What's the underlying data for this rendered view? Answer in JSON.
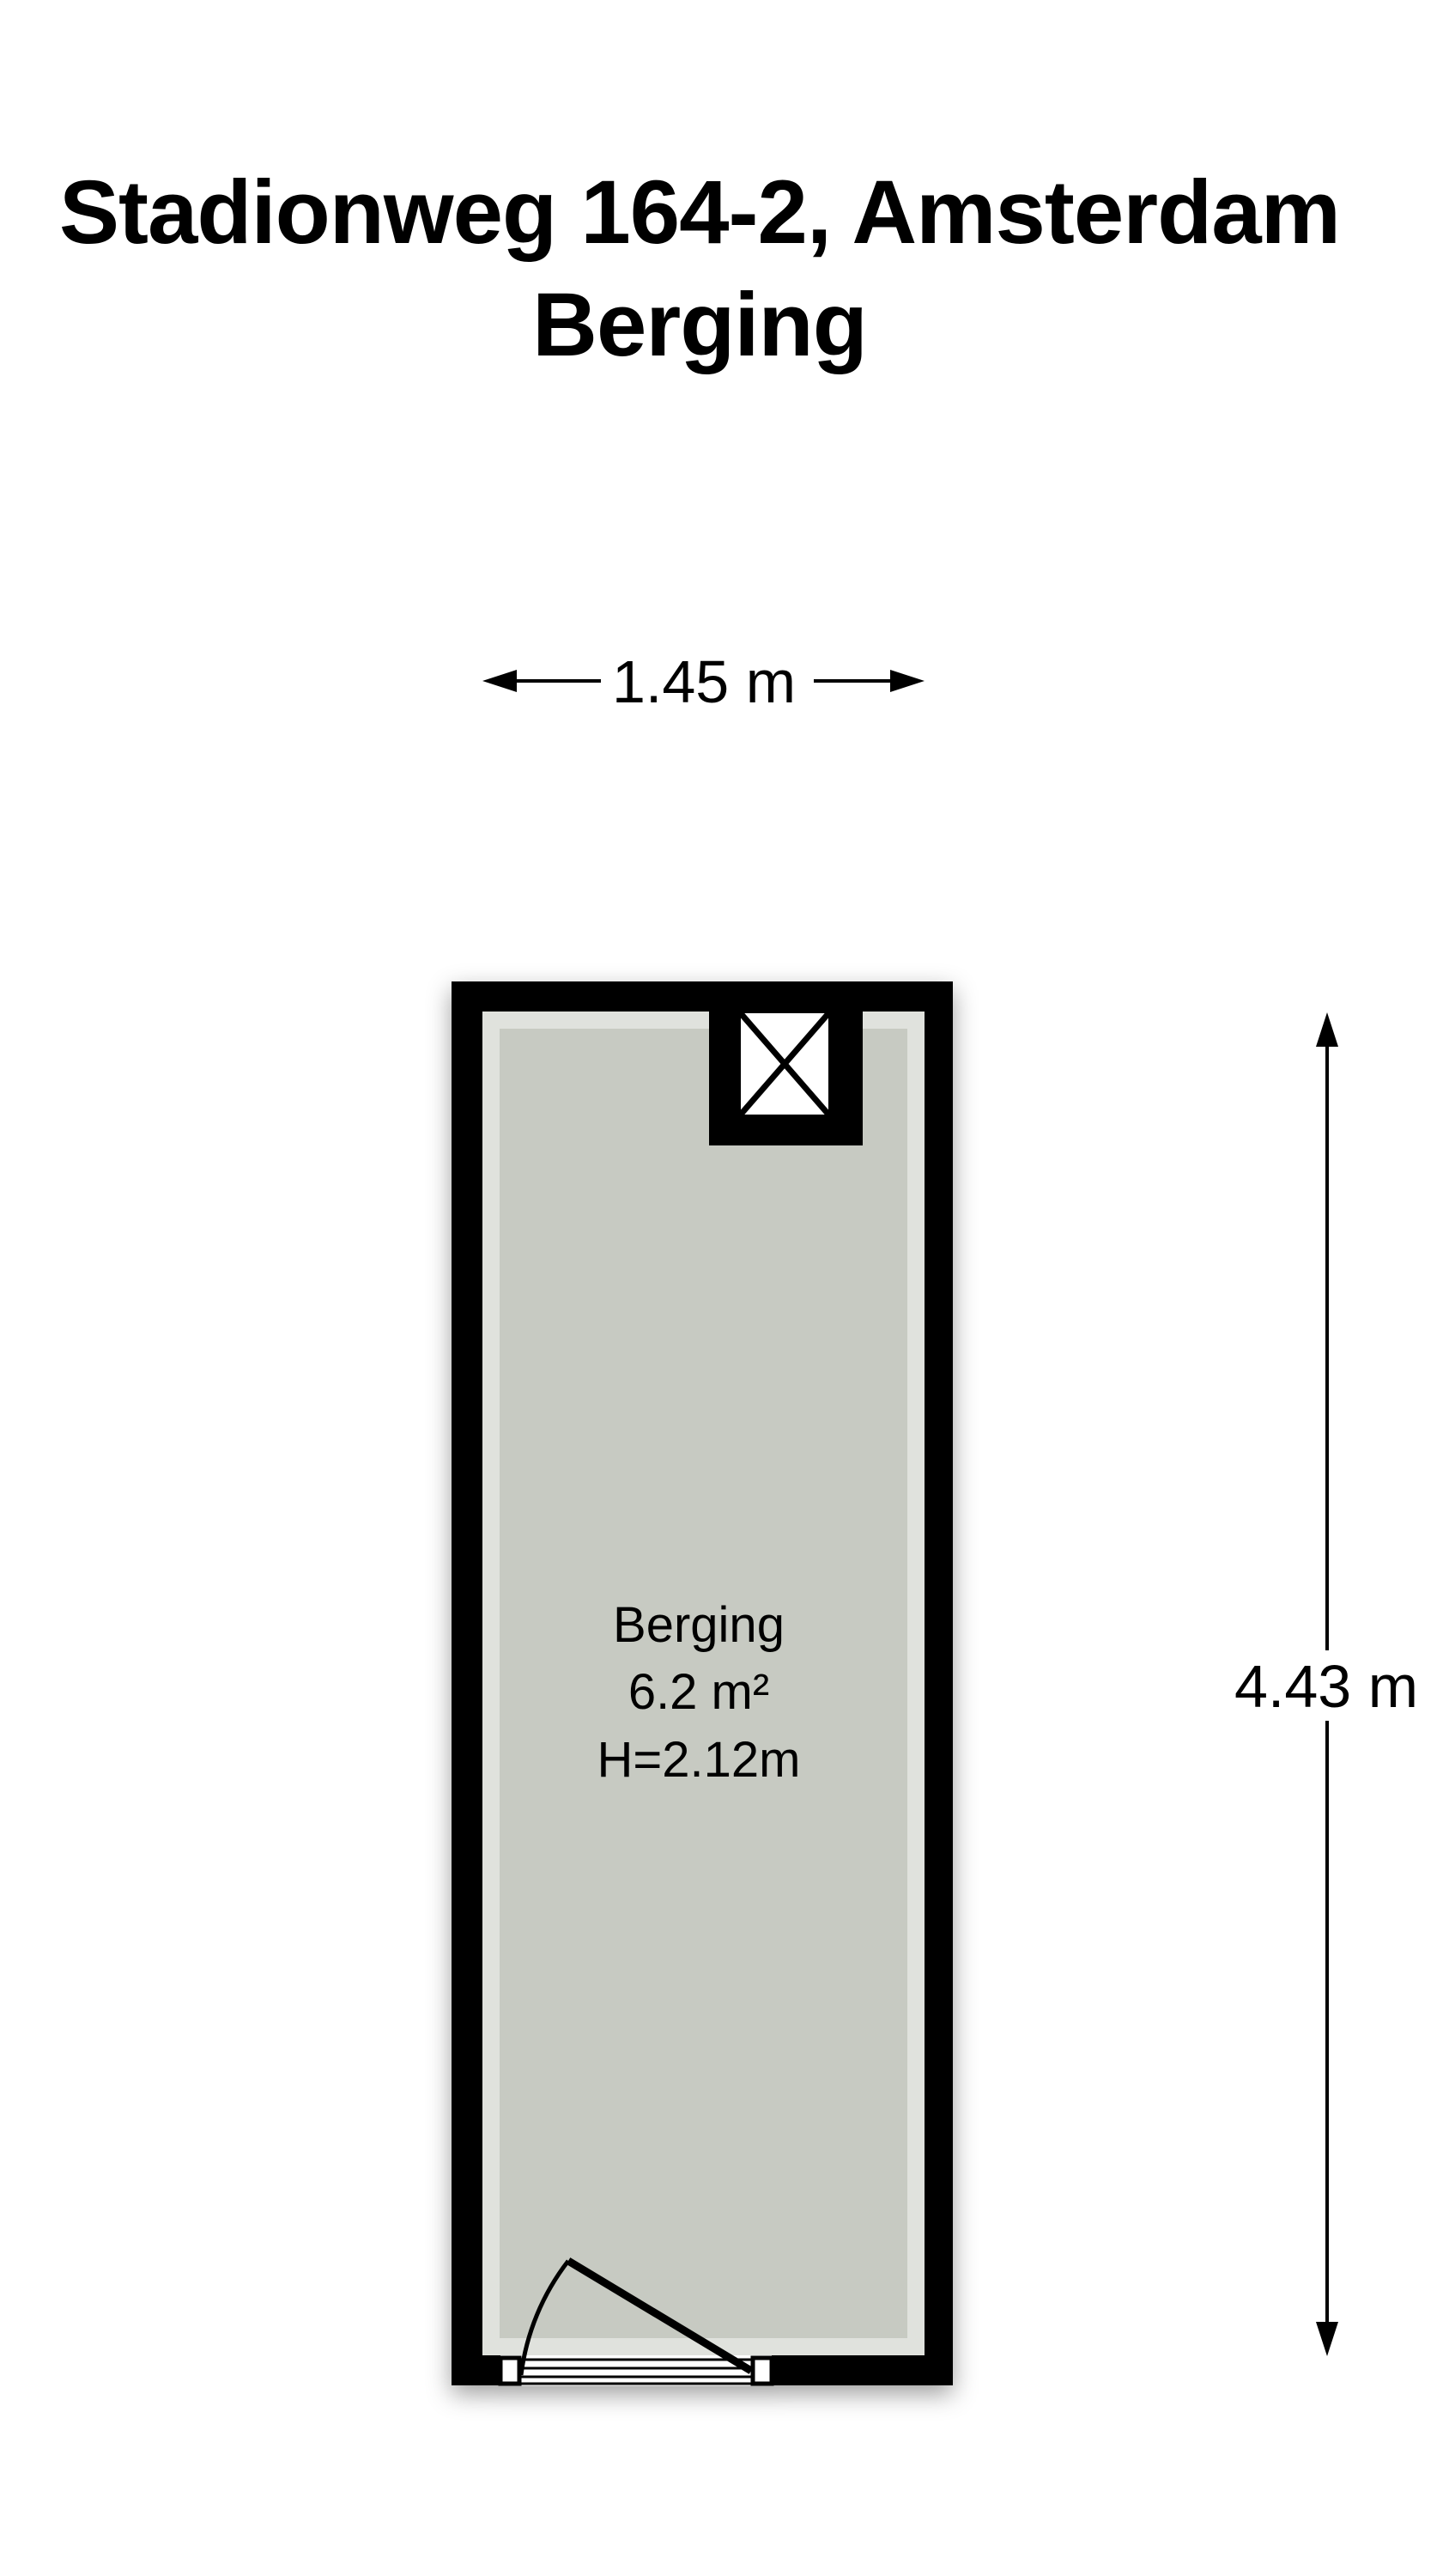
{
  "title": {
    "line1": "Stadionweg 164-2, Amsterdam",
    "line2": "Berging"
  },
  "room_label": {
    "name": "Berging",
    "area": "6.2 m²",
    "ceiling_height": "H=2.12m"
  },
  "dimensions": {
    "width": "1.45 m",
    "height": "4.43 m"
  },
  "colors": {
    "wall": "#000000",
    "floor": "#c7cac2",
    "background": "#ffffff",
    "line": "#000000"
  },
  "symbols": {
    "shaft": "crossed-box-shaft-icon",
    "door": "swing-door-symbol"
  }
}
